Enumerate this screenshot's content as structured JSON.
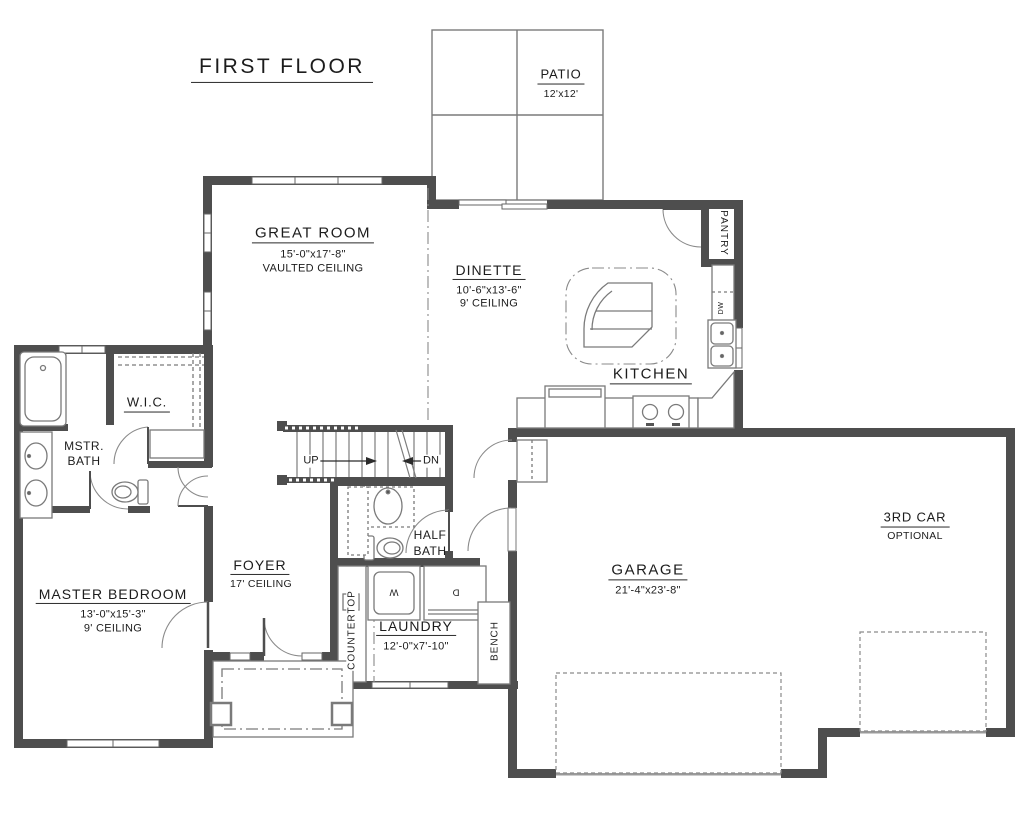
{
  "title": "FIRST FLOOR",
  "colors": {
    "wall": "#4e4e4e",
    "thin_line": "#7a7a7a",
    "text": "#1c1c1c",
    "background": "#ffffff"
  },
  "rooms": {
    "patio": {
      "name": "PATIO",
      "dims": "12'x12'"
    },
    "great_room": {
      "name": "GREAT ROOM",
      "dims": "15'-0\"x17'-8\"",
      "note": "VAULTED CEILING"
    },
    "dinette": {
      "name": "DINETTE",
      "dims": "10'-6\"x13'-6\"",
      "note": "9' CEILING"
    },
    "kitchen": {
      "name": "KITCHEN"
    },
    "pantry": {
      "name": "PANTRY"
    },
    "wic": {
      "name": "W.I.C."
    },
    "master_bath": {
      "name_line1": "MSTR.",
      "name_line2": "BATH"
    },
    "master_bedroom": {
      "name": "MASTER BEDROOM",
      "dims": "13'-0\"x15'-3\"",
      "note": "9' CEILING"
    },
    "foyer": {
      "name": "FOYER",
      "note": "17' CEILING"
    },
    "half_bath": {
      "name_line1": "HALF",
      "name_line2": "BATH"
    },
    "laundry": {
      "name": "LAUNDRY",
      "dims": "12'-0\"x7'-10\""
    },
    "garage": {
      "name": "GARAGE",
      "dims": "21'-4\"x23'-8\""
    },
    "third_car": {
      "name": "3RD CAR",
      "note": "OPTIONAL"
    }
  },
  "stairs": {
    "up": "UP",
    "down": "DN"
  },
  "appliances": {
    "washer": "W",
    "dryer": "D",
    "dishwasher": "DW"
  },
  "fixture_labels": {
    "countertop": "COUNTERTOP",
    "bench": "BENCH"
  }
}
